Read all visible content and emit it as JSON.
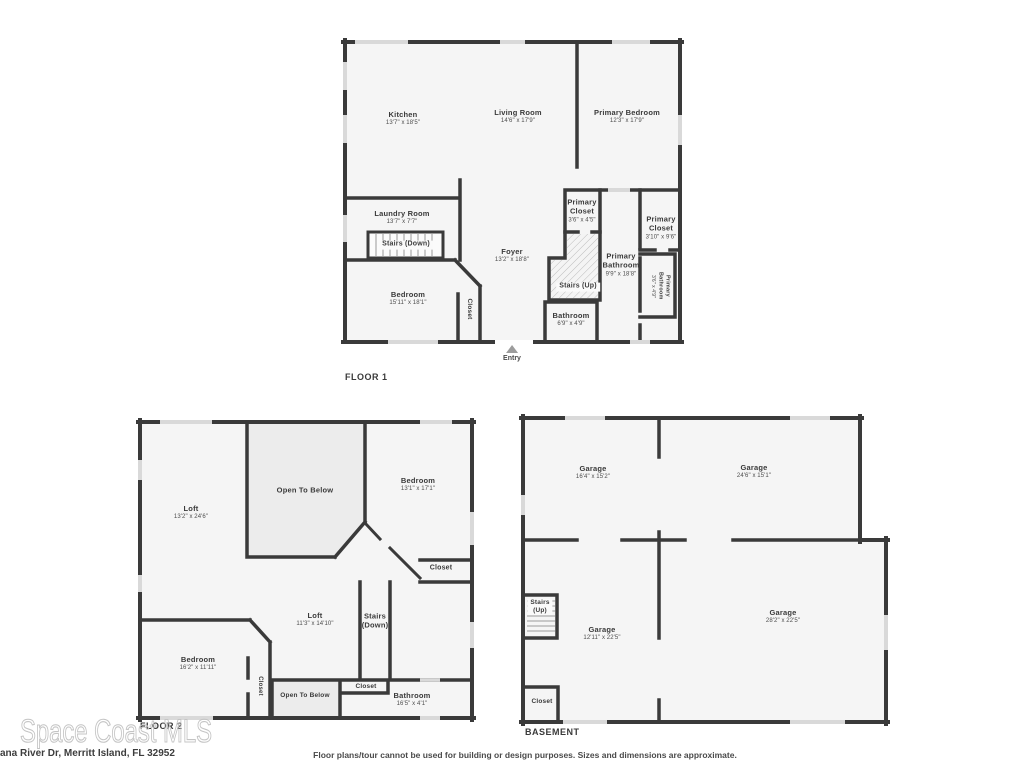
{
  "page": {
    "watermark": "Space Coast MLS",
    "address": "ana River Dr, Merritt Island, FL 32952",
    "disclaimer": "Floor plans/tour cannot be used for building or design purposes. Sizes and dimensions are approximate."
  },
  "colors": {
    "wall": "#3a3a3a",
    "room_fill": "#f5f5f5",
    "open_to_below_fill": "#ececec",
    "window": "#d9d9d9"
  },
  "floor1": {
    "title": "FLOOR 1",
    "entry": "Entry",
    "rooms": {
      "kitchen": {
        "name": "Kitchen",
        "dims": "13'7\" x 18'5\""
      },
      "living_room": {
        "name": "Living Room",
        "dims": "14'6\" x 17'9\""
      },
      "primary_bedroom": {
        "name": "Primary Bedroom",
        "dims": "12'3\" x 17'9\""
      },
      "laundry_room": {
        "name": "Laundry Room",
        "dims": "13'7\" x 7'7\""
      },
      "stairs_down": {
        "name": "Stairs (Down)"
      },
      "foyer": {
        "name": "Foyer",
        "dims": "13'2\" x 18'8\""
      },
      "bedroom": {
        "name": "Bedroom",
        "dims": "15'11\" x 18'1\""
      },
      "closet": {
        "name": "Closet"
      },
      "primary_closet_a": {
        "name": "Primary Closet",
        "dims": "3'6\" x 4'5\""
      },
      "stairs_up": {
        "name": "Stairs (Up)"
      },
      "bathroom": {
        "name": "Bathroom",
        "dims": "6'9\" x 4'9\""
      },
      "primary_bathroom": {
        "name": "Primary Bathroom",
        "dims": "9'9\" x 18'8\""
      },
      "primary_closet_b": {
        "name": "Primary Closet",
        "dims": "3'10\" x 9'6\""
      },
      "primary_bathroom_small": {
        "name": "Primary Bathroom",
        "dims": "3'6\" x 4'9\""
      }
    }
  },
  "floor2": {
    "title": "FLOOR 2",
    "rooms": {
      "loft_a": {
        "name": "Loft",
        "dims": "13'2\" x 24'6\""
      },
      "open_to_below_a": {
        "name": "Open To Below"
      },
      "bedroom_a": {
        "name": "Bedroom",
        "dims": "13'1\" x 17'1\""
      },
      "closet_a": {
        "name": "Closet"
      },
      "loft_b": {
        "name": "Loft",
        "dims": "11'3\" x 14'10\""
      },
      "stairs_down_1": {
        "name": "Stairs"
      },
      "stairs_down_2": {
        "name": "(Down)"
      },
      "bedroom_b": {
        "name": "Bedroom",
        "dims": "16'2\" x 11'11\""
      },
      "closet_b": {
        "name": "Closet"
      },
      "open_to_below_b": {
        "name": "Open To Below"
      },
      "closet_c": {
        "name": "Closet"
      },
      "bathroom": {
        "name": "Bathroom",
        "dims": "16'5\" x 4'1\""
      }
    }
  },
  "basement": {
    "title": "BASEMENT",
    "rooms": {
      "garage_a": {
        "name": "Garage",
        "dims": "16'4\" x 15'2\""
      },
      "garage_b": {
        "name": "Garage",
        "dims": "24'6\" x 15'1\""
      },
      "stairs_up_1": {
        "name": "Stairs"
      },
      "stairs_up_2": {
        "name": "(Up)"
      },
      "garage_c": {
        "name": "Garage",
        "dims": "12'11\" x 22'5\""
      },
      "garage_d": {
        "name": "Garage",
        "dims": "28'2\" x 22'5\""
      },
      "closet": {
        "name": "Closet"
      }
    }
  }
}
